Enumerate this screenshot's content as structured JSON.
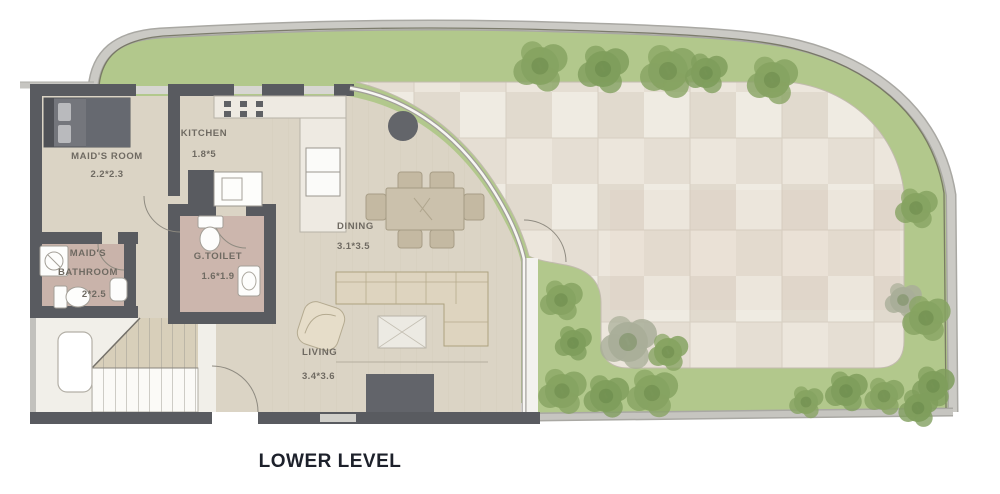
{
  "title": "LOWER LEVEL",
  "rooms": {
    "maids_room": {
      "name": "MAID'S ROOM",
      "dims": "2.2*2.3"
    },
    "kitchen": {
      "name": "KITCHEN",
      "dims": "1.8*5"
    },
    "maids_bathroom": {
      "name": "MAID'S BATHROOM",
      "dims": "2*2.5"
    },
    "g_toilet": {
      "name": "G.TOILET",
      "dims": "1.6*1.9"
    },
    "dining": {
      "name": "DINING",
      "dims": "3.1*3.5"
    },
    "living": {
      "name": "LIVING",
      "dims": "3.4*3.6"
    }
  },
  "colors": {
    "wall": "#595b60",
    "site_wall": "#c9c8c3",
    "grass": "#b2c88c",
    "tree": "#86a361",
    "patio": "#e8e3d9",
    "wood_floor": "#dbd4c5",
    "bath_floor": "#c9b3aa",
    "furniture_tan": "#cbc1ac",
    "label_text": "#6f6a62",
    "title_text": "#1d212b"
  }
}
